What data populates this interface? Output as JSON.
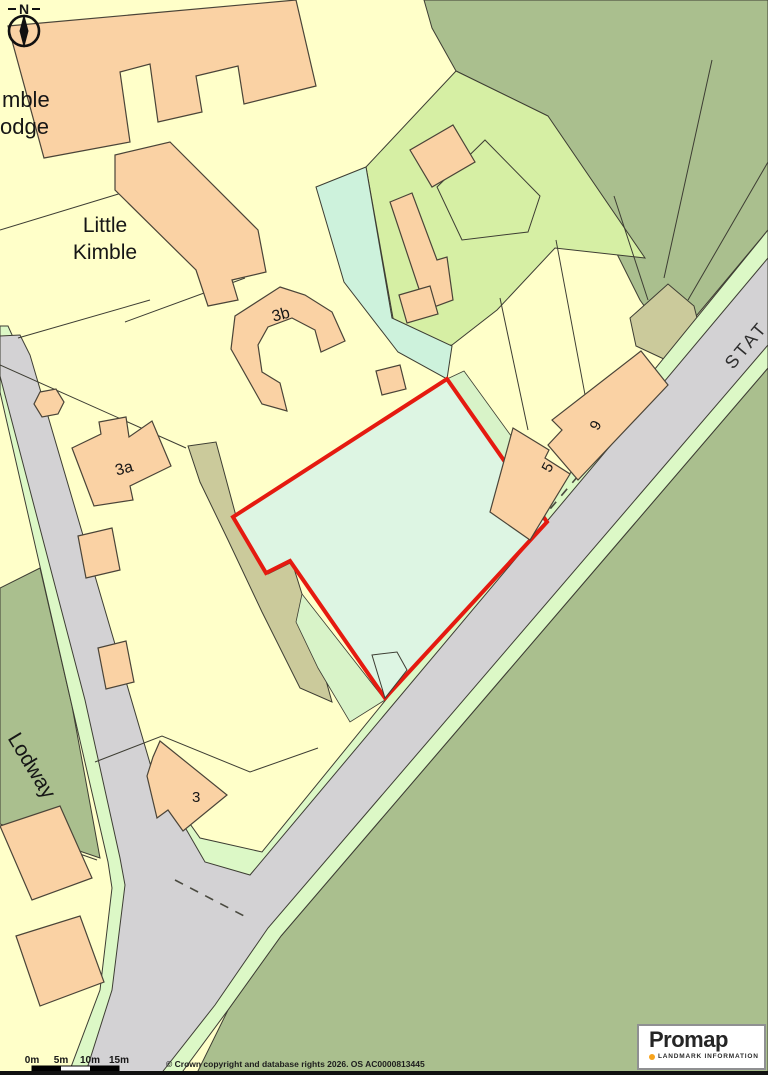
{
  "map": {
    "place_labels": {
      "kimble_lodge_line1": "mble",
      "kimble_lodge_line2": "odge",
      "little_kimble_line1": "Little",
      "little_kimble_line2": "Kimble",
      "lodway": "Lodway",
      "station_road_partial": "STAT"
    },
    "plot_labels": {
      "b3b": "3b",
      "b3a": "3a",
      "b3": "3",
      "b5": "5",
      "b9": "9"
    },
    "compass": {
      "north_label": "N"
    },
    "scale_bar": {
      "labels": [
        "0m",
        "5m",
        "10m",
        "15m"
      ]
    },
    "footer": {
      "copyright": "© Crown copyright and database rights 2026. OS AC0000813445"
    },
    "logo": {
      "brand": "Promap",
      "tagline": "LANDMARK INFORMATION",
      "dot_color": "#F7A31C"
    },
    "colors": {
      "parcel_yellow": "#FFFFC9",
      "field_sage": "#AABF8E",
      "parcel_light_green": "#D6EFA4",
      "plot_mint": "#DDF5E3",
      "mint_strip": "#CDF2DC",
      "road_verge_green": "#DCF8C6",
      "road_grey": "#D3D2D4",
      "driveway_khaki": "#CBCA9B",
      "building_peach": "#FAD2A4",
      "site_boundary_red": "#E51A10"
    }
  }
}
